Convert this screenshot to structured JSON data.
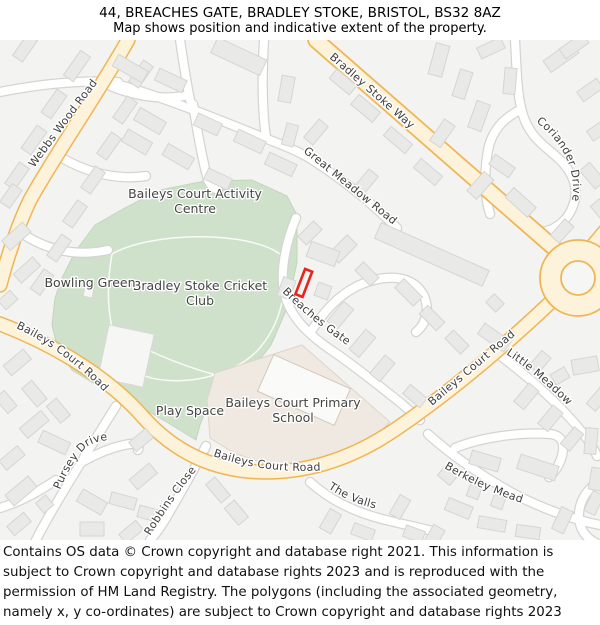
{
  "header": {
    "title": "44, BREACHES GATE, BRADLEY STOKE, BRISTOL, BS32 8AZ",
    "subtitle": "Map shows position and indicative extent of the property."
  },
  "map": {
    "street_labels": {
      "webbs_wood_road": "Webbs Wood Road",
      "bradley_stoke_way": "Bradley Stoke Way",
      "great_meadow_road": "Great Meadow Road",
      "coriander_drive": "Coriander Drive",
      "breaches_gate": "Breaches Gate",
      "baileys_court_road_west": "Baileys Court Road",
      "baileys_court_road_south": "Baileys Court Road",
      "baileys_court_road_east": "Baileys Court Road",
      "little_meadow": "Little Meadow",
      "berkeley_mead": "Berkeley Mead",
      "the_valls": "The Valls",
      "pursey_drive": "Pursey Drive",
      "robbins_close": "Robbins Close"
    },
    "area_labels": {
      "activity_centre_line1": "Baileys Court Activity",
      "activity_centre_line2": "Centre",
      "cricket_club_line1": "Bradley Stoke Cricket",
      "cricket_club_line2": "Club",
      "bowling_green": "Bowling Green",
      "play_space": "Play Space",
      "school_line1": "Baileys Court Primary",
      "school_line2": "School"
    },
    "colors": {
      "map_background": "#f3f3f1",
      "major_road_fill": "#fdf2da",
      "major_road_casing": "#f0b553",
      "minor_road_fill": "#ffffff",
      "minor_road_casing": "#d4d4d2",
      "green_area": "#cfe1ca",
      "school_area": "#efe9e1",
      "building_fill": "#e9e9e7",
      "property_outline": "#e8241d"
    }
  },
  "footer": {
    "attribution": "Contains OS data © Crown copyright and database right 2021. This information is subject to Crown copyright and database rights 2023 and is reproduced with the permission of HM Land Registry. The polygons (including the associated geometry, namely x, y co-ordinates) are subject to Crown copyright and database rights 2023 Ordnance Survey 100026316."
  }
}
